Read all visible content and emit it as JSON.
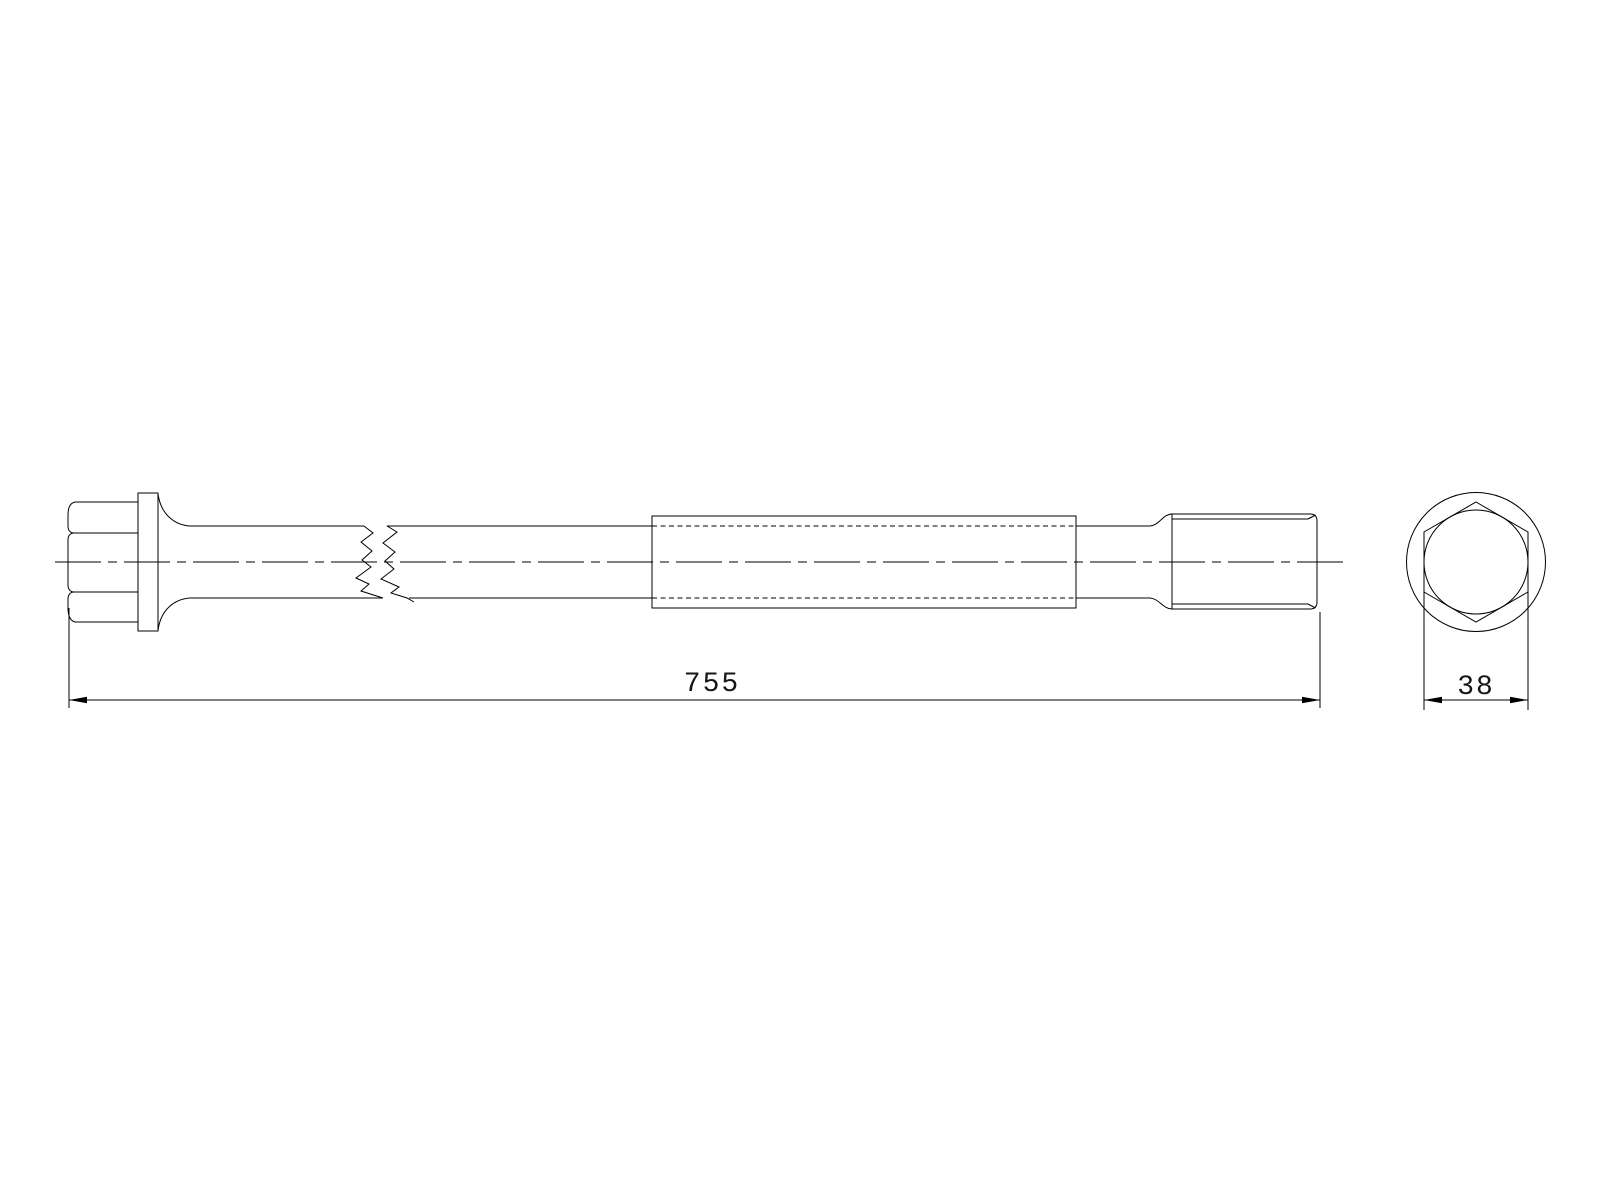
{
  "page": {
    "background_color": "#ffffff",
    "line_color": "#000000"
  },
  "drawing": {
    "dimensions": {
      "overall_length": {
        "label": "755"
      },
      "width_across_flats": {
        "label": "38"
      }
    }
  }
}
